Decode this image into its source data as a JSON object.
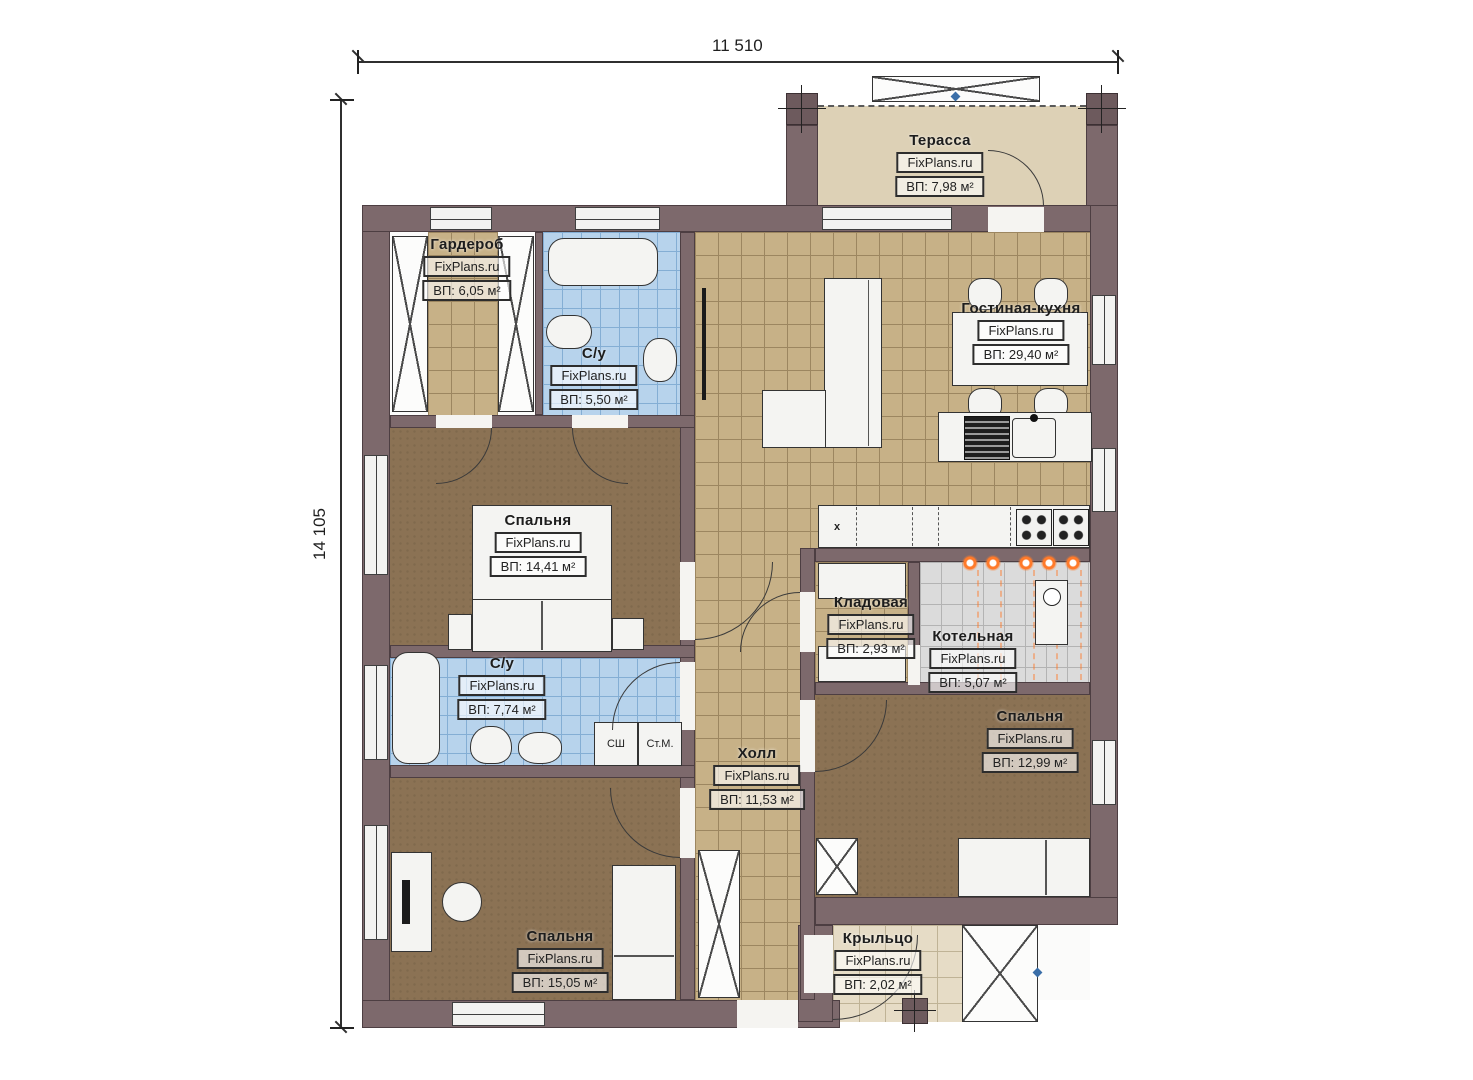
{
  "plan": {
    "brand": "FixPlans.ru",
    "dimensions": {
      "top": "11 510",
      "left": "14 105"
    },
    "rooms": [
      {
        "id": "terrace",
        "name": "Терасса",
        "area": "ВП: 7,98 м²"
      },
      {
        "id": "wardrobe",
        "name": "Гардероб",
        "area": "ВП: 6,05 м²"
      },
      {
        "id": "bath1",
        "name": "С/у",
        "area": "ВП: 5,50 м²"
      },
      {
        "id": "living",
        "name": "Гостиная-кухня",
        "area": "ВП: 29,40 м²"
      },
      {
        "id": "bedroom1",
        "name": "Спальня",
        "area": "ВП: 14,41 м²"
      },
      {
        "id": "bath2",
        "name": "С/у",
        "area": "ВП: 7,74 м²"
      },
      {
        "id": "pantry",
        "name": "Кладовая",
        "area": "ВП: 2,93 м²"
      },
      {
        "id": "boiler",
        "name": "Котельная",
        "area": "ВП: 5,07 м²"
      },
      {
        "id": "hall",
        "name": "Холл",
        "area": "ВП: 11,53 м²"
      },
      {
        "id": "bedroom2",
        "name": "Спальня",
        "area": "ВП: 12,99 м²"
      },
      {
        "id": "bedroom3",
        "name": "Спальня",
        "area": "ВП: 15,05 м²"
      },
      {
        "id": "porch",
        "name": "Крыльцо",
        "area": "ВП: 2,02 м²"
      }
    ],
    "labels": {
      "dryer_cabinet": "СШ",
      "washer": "Ст.М.",
      "cabinet_mark": "x"
    },
    "colors": {
      "wall": "#7d696c",
      "tile_tan": "#c7b187",
      "tile_blue": "#b7d3ec",
      "floor_brown": "#8b7254",
      "terrace": "#ddd1b6",
      "boiler_tile": "#dbdbdb",
      "heating_accent": "#ff7a2a"
    }
  }
}
